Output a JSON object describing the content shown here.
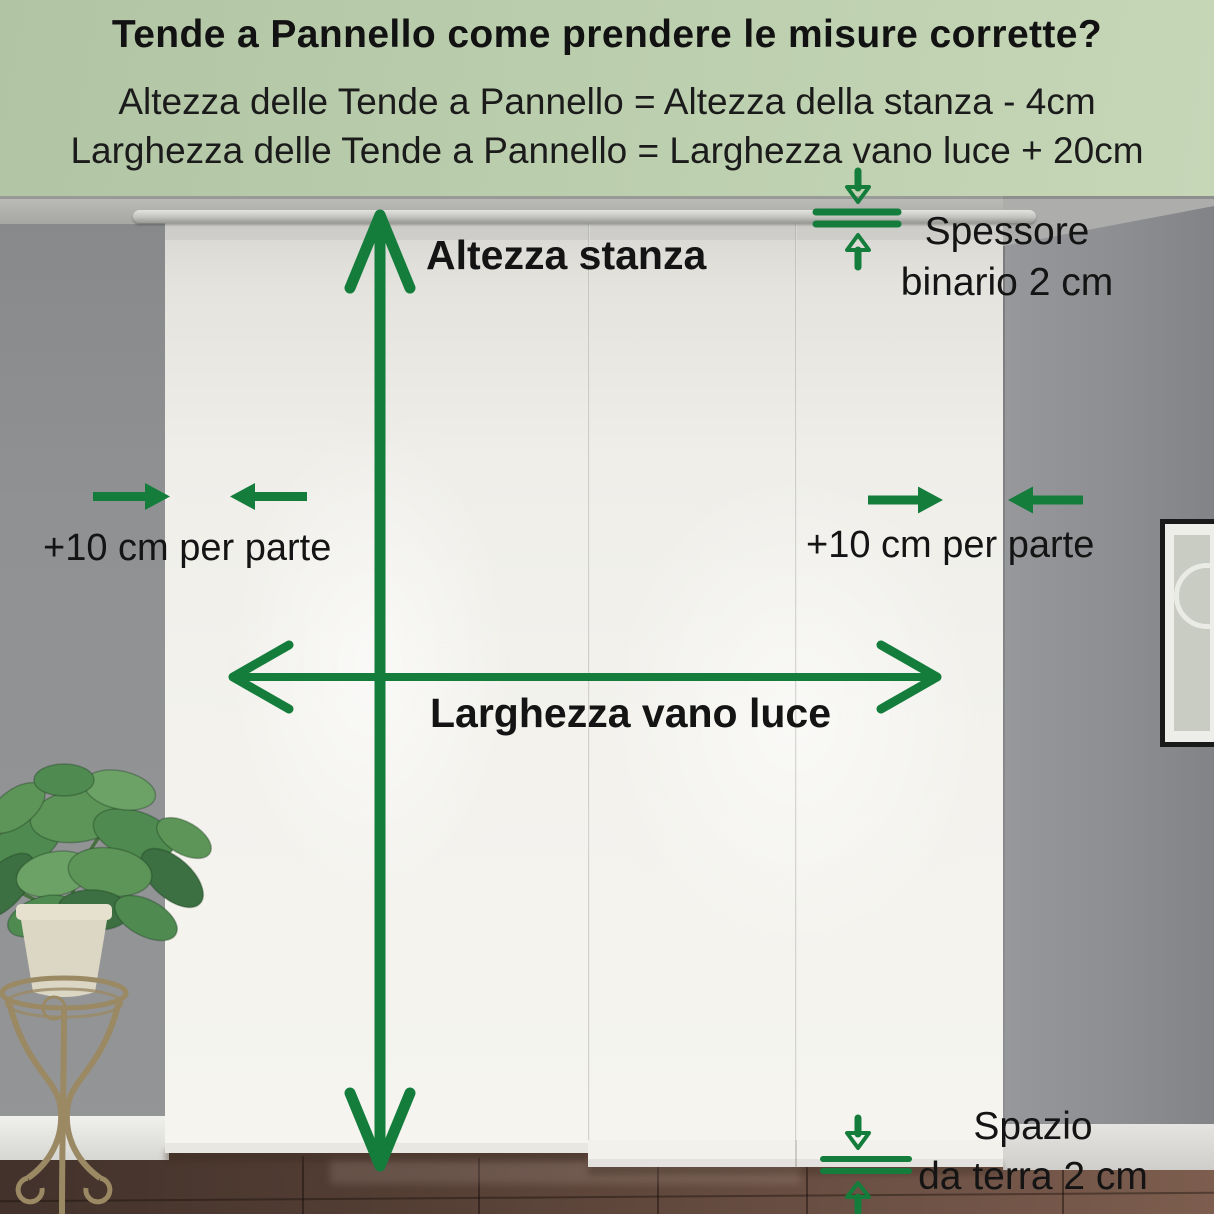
{
  "header": {
    "title": "Tende a Pannello come prendere le misure corrette?",
    "formula_height": "Altezza delle Tende a Pannello = Altezza della stanza - 4cm",
    "formula_width": "Larghezza delle Tende a Pannello = Larghezza vano luce + 20cm"
  },
  "annotations": {
    "room_height_label": "Altezza stanza",
    "opening_width_label": "Larghezza vano luce",
    "side_margin_left_label": "+10 cm per parte",
    "side_margin_right_label": "+10 cm per parte",
    "rail_thickness_line1": "Spessore",
    "rail_thickness_line2": "binario 2 cm",
    "floor_gap_line1": "Spazio",
    "floor_gap_line2": "da terra 2 cm"
  },
  "colors": {
    "accent_green": "#147D3C",
    "header_background": "#B9CCAD",
    "label_text": "#141414",
    "wall_gray": "#8E9092",
    "curtain_white": "#F3F2ED",
    "floor_brown": "#5E463B"
  }
}
